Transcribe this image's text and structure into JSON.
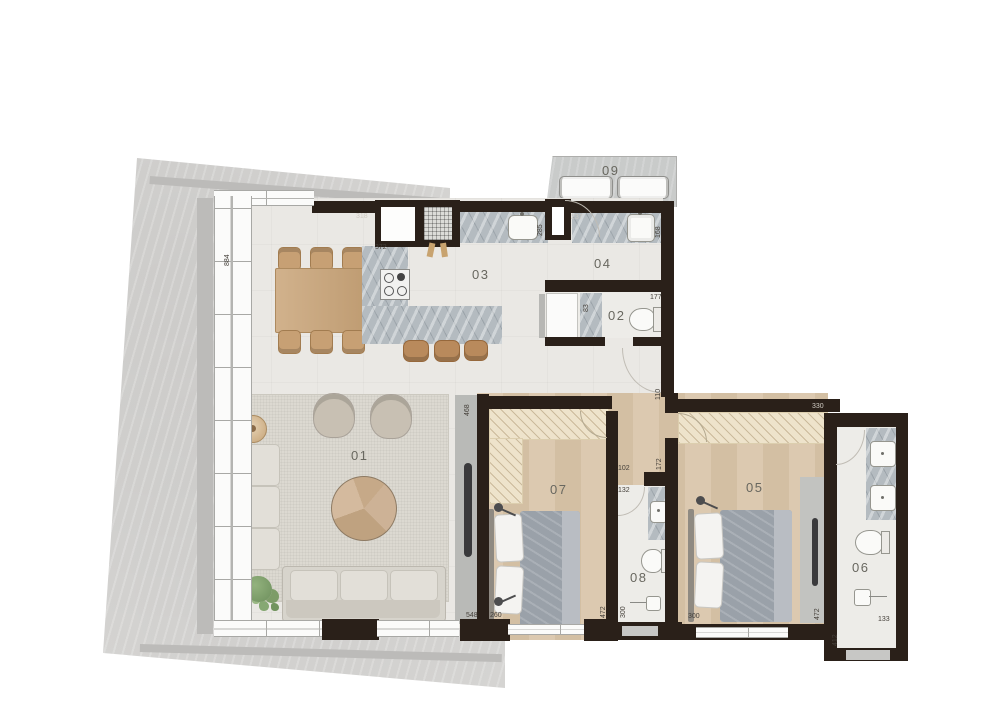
{
  "plan_title": "apartment-floor-plan",
  "rooms": [
    "01",
    "02",
    "03",
    "04",
    "05",
    "06",
    "07",
    "08",
    "09"
  ],
  "dimensions": [
    "884",
    "318",
    "372",
    "237",
    "285",
    "168",
    "83",
    "177",
    "110",
    "468",
    "330",
    "102",
    "132",
    "172",
    "548",
    "260",
    "472",
    "300",
    "300",
    "472",
    "412",
    "133"
  ],
  "colors": {
    "wall": "#2a2019",
    "slab": "#d8d7d5",
    "social_floor": "#eae8e4",
    "wood_floor": "#d8c5aa",
    "marble": "#b4bbc0",
    "wardrobe": "#eee3cb",
    "furniture_wood": "#c9a478"
  }
}
